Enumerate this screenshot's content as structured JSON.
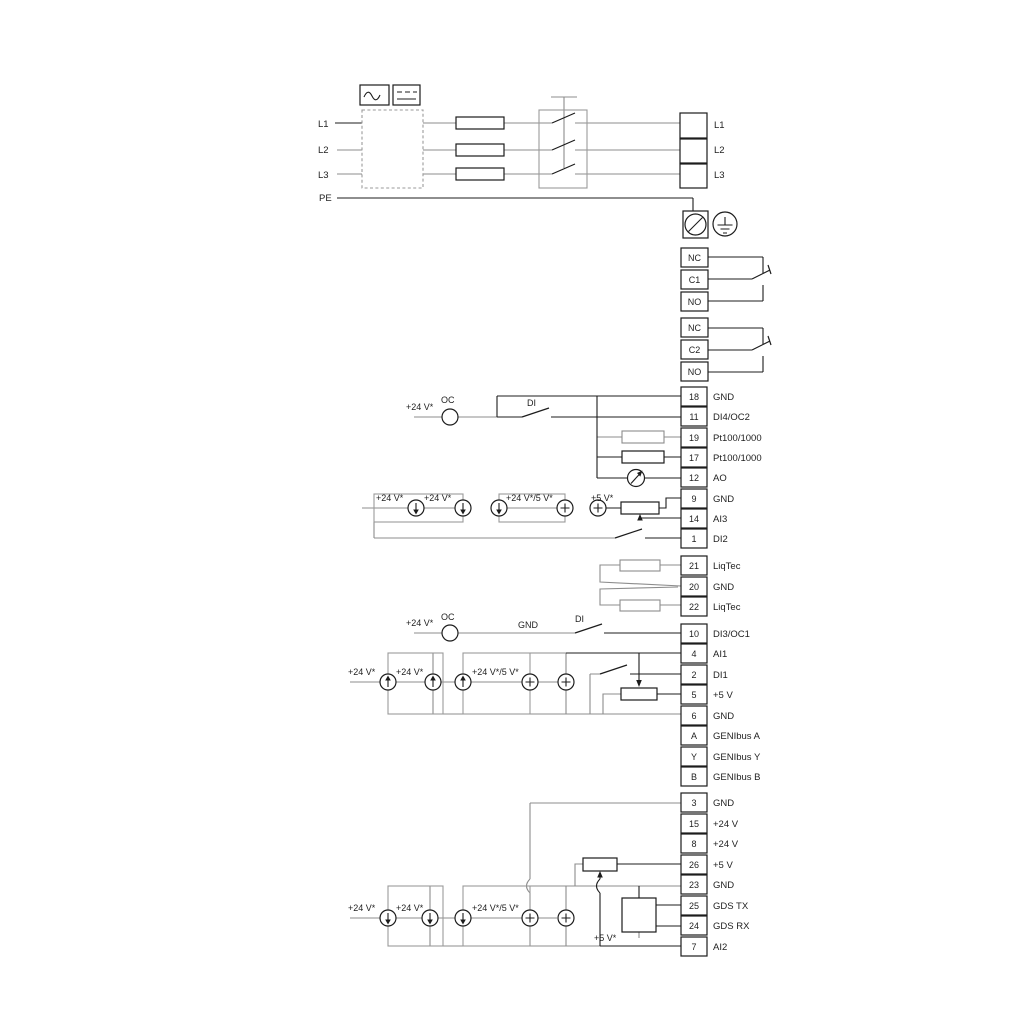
{
  "mains": {
    "input_lines": [
      "L1",
      "L2",
      "L3",
      "PE"
    ],
    "output_terminals": [
      "L1",
      "L2",
      "L3"
    ]
  },
  "relays": [
    {
      "terminals": [
        "NC",
        "C1",
        "NO"
      ]
    },
    {
      "terminals": [
        "NC",
        "C2",
        "NO"
      ]
    }
  ],
  "io_strip_1": [
    {
      "num": "18",
      "label": "GND"
    },
    {
      "num": "11",
      "label": "DI4/OC2"
    },
    {
      "num": "19",
      "label": "Pt100/1000"
    },
    {
      "num": "17",
      "label": "Pt100/1000"
    },
    {
      "num": "12",
      "label": "AO"
    },
    {
      "num": "9",
      "label": "GND"
    },
    {
      "num": "14",
      "label": "AI3"
    },
    {
      "num": "1",
      "label": "DI2"
    }
  ],
  "liqtec_strip": [
    {
      "num": "21",
      "label": "LiqTec"
    },
    {
      "num": "20",
      "label": "GND"
    },
    {
      "num": "22",
      "label": "LiqTec"
    }
  ],
  "io_strip_2": [
    {
      "num": "10",
      "label": "DI3/OC1"
    },
    {
      "num": "4",
      "label": "AI1"
    },
    {
      "num": "2",
      "label": "DI1"
    },
    {
      "num": "5",
      "label": "+5 V"
    },
    {
      "num": "6",
      "label": "GND"
    },
    {
      "num": "A",
      "label": "GENIbus A"
    },
    {
      "num": "Y",
      "label": "GENIbus Y"
    },
    {
      "num": "B",
      "label": "GENIbus B"
    }
  ],
  "io_strip_3": [
    {
      "num": "3",
      "label": "GND"
    },
    {
      "num": "15",
      "label": "+24 V"
    },
    {
      "num": "8",
      "label": "+24 V"
    },
    {
      "num": "26",
      "label": "+5 V"
    },
    {
      "num": "23",
      "label": "GND"
    },
    {
      "num": "25",
      "label": "GDS TX"
    },
    {
      "num": "24",
      "label": "GDS RX"
    },
    {
      "num": "7",
      "label": "AI2"
    }
  ],
  "annotations": {
    "oc": "OC",
    "di": "DI",
    "gnd": "GND",
    "v24": "+24 V*",
    "v24_5": "+24 V*/5 V*",
    "v5": "+5 V*"
  },
  "colors": {
    "wire_gray": "#8c8c8c",
    "wire_black": "#1c1c1c",
    "background": "#ffffff"
  }
}
